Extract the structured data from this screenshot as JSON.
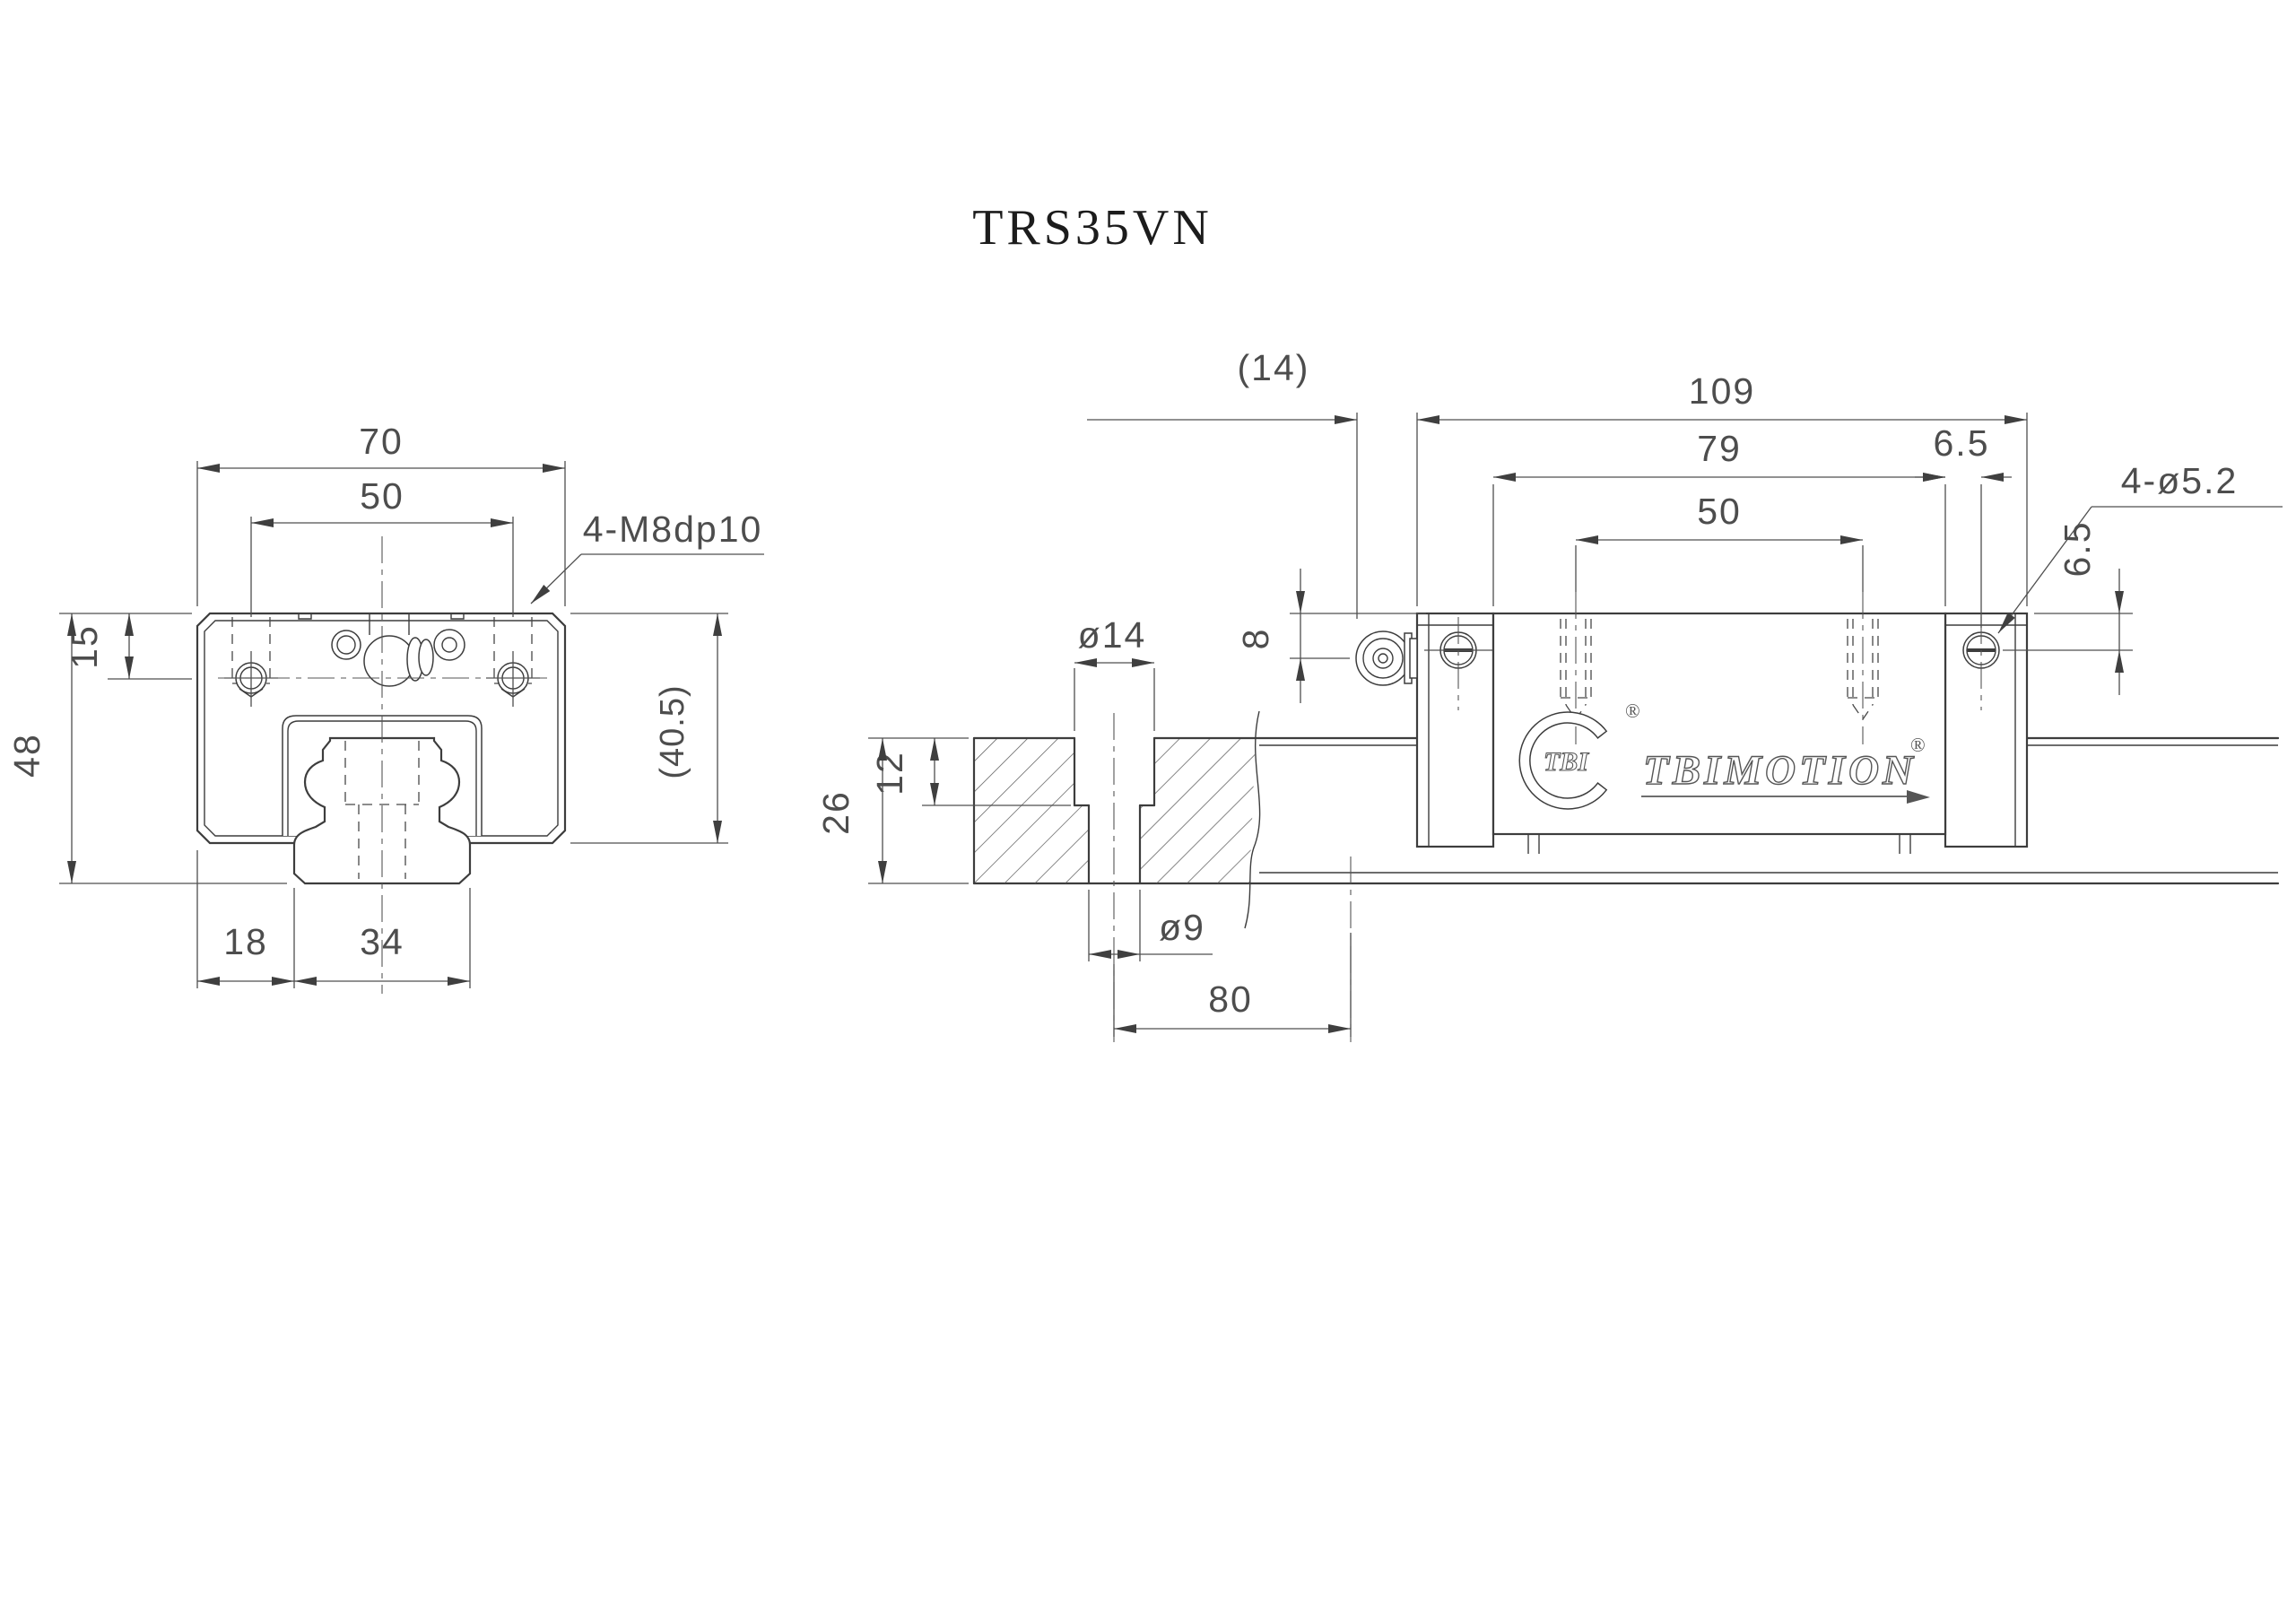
{
  "title": "TRS35VN",
  "front_view": {
    "dim_width": "70",
    "dim_hole_pitch": "50",
    "thread_callout": "4-M8dp10",
    "dim_top_to_hole": "15",
    "dim_total_height": "48",
    "dim_block_height": "(40.5)",
    "dim_edge_to_rail": "18",
    "dim_rail_width": "34"
  },
  "side_view": {
    "dim_nipple_protrusion": "(14)",
    "dim_total_length": "109",
    "dim_body_length": "79",
    "dim_cap_hole_offset": "6.5",
    "dim_mount_hole_pitch": "50",
    "cap_hole_callout": "4-ø5.2",
    "dim_cap_hole_depth": "6.5",
    "dim_nipple_center": "8",
    "dim_counterbore_dia": "ø14",
    "dim_counterbore_depth": "12",
    "dim_rail_height": "26",
    "dim_rail_hole_dia": "ø9",
    "dim_rail_hole_pitch": "80",
    "logo": {
      "monogram": "TBI",
      "brand": "TBIMOTION",
      "registered": "®"
    }
  }
}
